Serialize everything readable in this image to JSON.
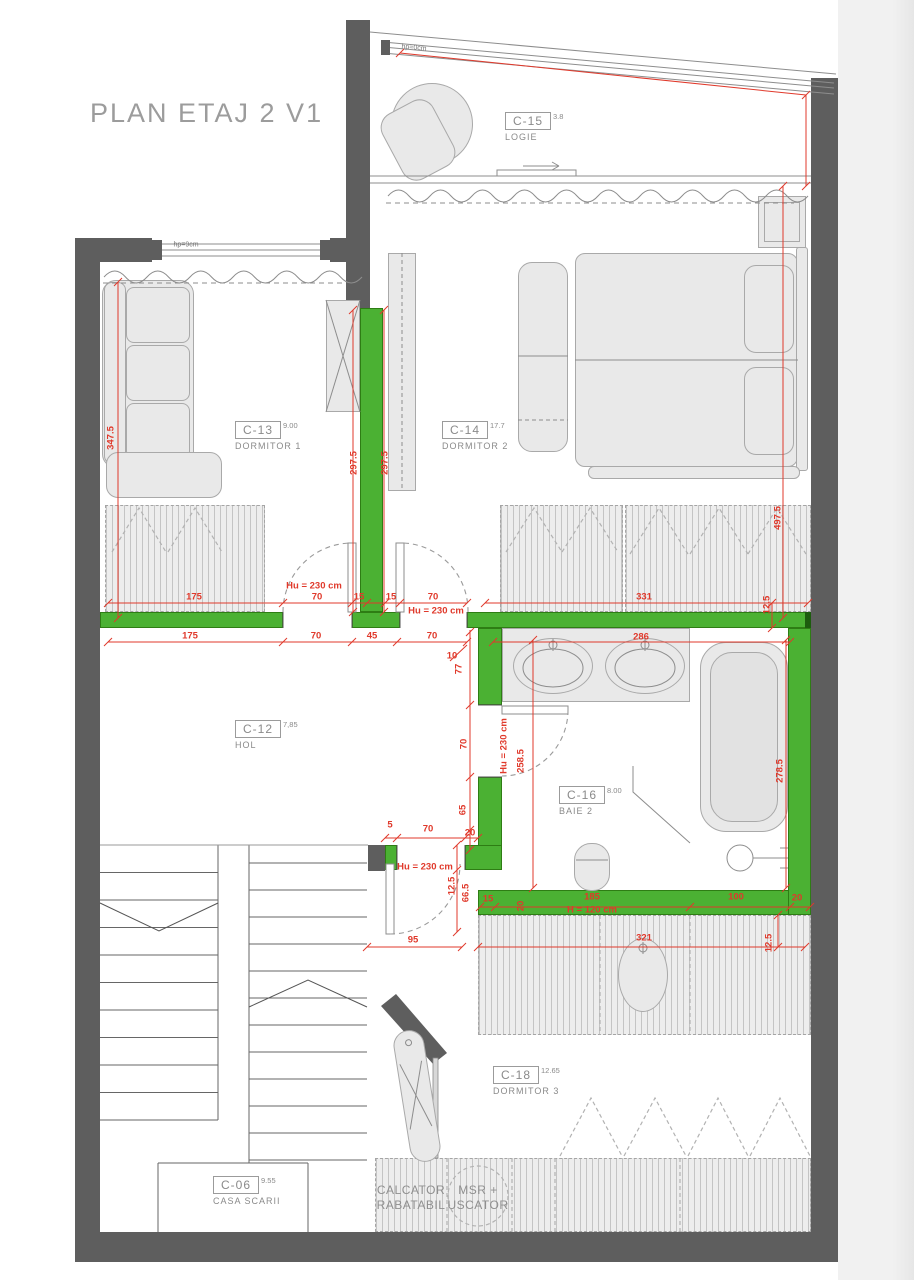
{
  "title": "PLAN ETAJ 2 V1",
  "rooms": {
    "c15": {
      "code": "C-15",
      "area": "3.8",
      "name": "LOGIE"
    },
    "c13": {
      "code": "C-13",
      "area": "9.00",
      "name": "DORMITOR 1"
    },
    "c14": {
      "code": "C-14",
      "area": "17.7",
      "name": "DORMITOR 2"
    },
    "c12": {
      "code": "C-12",
      "area": "7,85",
      "name": "HOL"
    },
    "c16": {
      "code": "C-16",
      "area": "8.00",
      "name": "BAIE 2"
    },
    "c18": {
      "code": "C-18",
      "area": "12.65",
      "name": "DORMITOR 3"
    },
    "c06": {
      "code": "C-06",
      "area": "9.55",
      "name": "CASA SCARII"
    }
  },
  "dimensions": [
    "347.5",
    "297.5",
    "297.5",
    "497.5",
    "175",
    "70",
    "15",
    "15",
    "70",
    "Hu = 230 cm",
    "Hu = 230 cm",
    "331",
    "12.5",
    "175",
    "70",
    "45",
    "70",
    "286",
    "10",
    "77",
    "70",
    "65",
    "20",
    "Hu = 230 cm",
    "258.5",
    "278.5",
    "5",
    "70",
    "Hu = 230 cm",
    "12.5",
    "66.5",
    "95",
    "15",
    "20",
    "185",
    "H = 120 cm",
    "100",
    "20",
    "321",
    "12.5"
  ],
  "annotations": {
    "window_note_left": "hp=9cm",
    "window_note_top": "hp=0cm",
    "closet_1a": "CALCATOR",
    "closet_1b": "RABATABIL",
    "closet_2a": "MSR +",
    "closet_2b": "USCATOR"
  },
  "colors": {
    "wall": "#5e5e5e",
    "partition_green": "#4bb133",
    "dimension_red": "#e0392b",
    "furniture_fill": "#e9e9e9",
    "furniture_stroke": "#a9a9a9",
    "label_gray": "#8a8a8a"
  }
}
